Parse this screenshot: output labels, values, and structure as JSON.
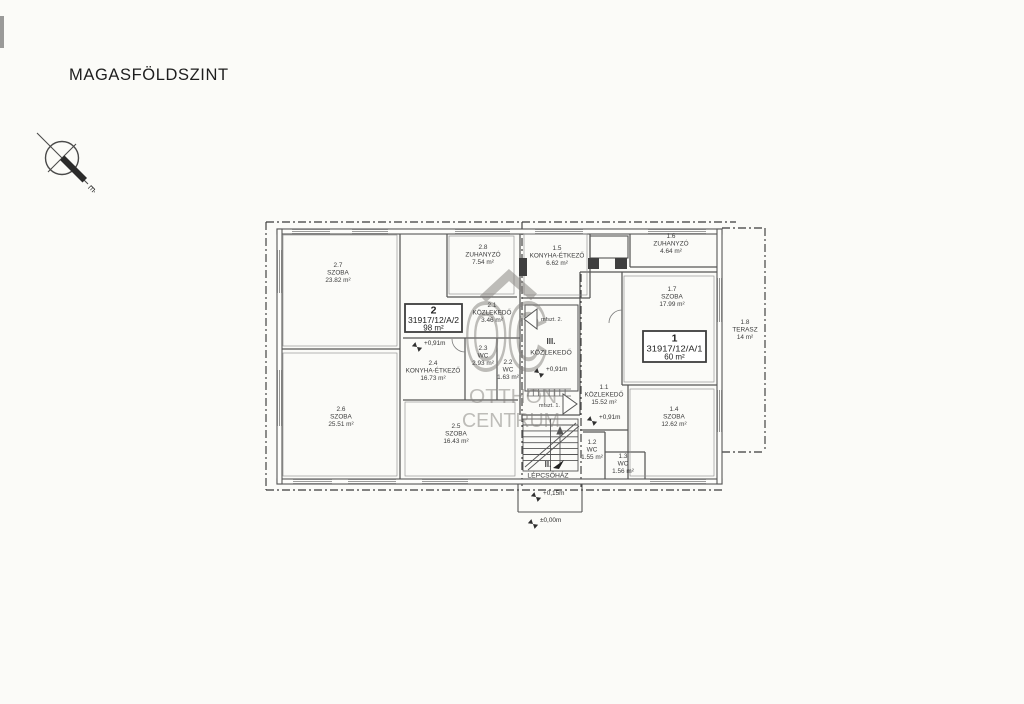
{
  "page": {
    "title": "MAGASFÖLDSZINT"
  },
  "compass": {
    "north_label": "É"
  },
  "watermark": {
    "logo": "OC",
    "line1": "OTTHON",
    "line2": "CENTRUM"
  },
  "units": [
    {
      "number": "2",
      "parcel": "31917/12/A/2",
      "area": "98 m²"
    },
    {
      "number": "1",
      "parcel": "31917/12/A/1",
      "area": "60 m²"
    }
  ],
  "rooms": [
    {
      "num": "2.7",
      "name": "SZOBA",
      "area": "23.82 m²",
      "x": 338,
      "y": 267
    },
    {
      "num": "2.6",
      "name": "SZOBA",
      "area": "25.51 m²",
      "x": 341,
      "y": 411
    },
    {
      "num": "2.8",
      "name": "ZUHANYZÓ",
      "area": "7.54 m²",
      "x": 483,
      "y": 249
    },
    {
      "num": "2.1",
      "name": "KÖZLEKEDŐ",
      "area": "3.46 m²",
      "x": 492,
      "y": 307
    },
    {
      "num": "2.3",
      "name": "WC",
      "area": "2.93 m²",
      "x": 483,
      "y": 350
    },
    {
      "num": "2.2",
      "name": "WC",
      "area": "1.63 m²",
      "x": 508,
      "y": 364
    },
    {
      "num": "2.4",
      "name": "KONYHA-ÉTKEZŐ",
      "area": "16.73 m²",
      "x": 433,
      "y": 365
    },
    {
      "num": "2.5",
      "name": "SZOBA",
      "area": "16.43 m²",
      "x": 456,
      "y": 428
    },
    {
      "num": "1.5",
      "name": "KONYHA-ÉTKEZŐ",
      "area": "6.62 m²",
      "x": 557,
      "y": 250
    },
    {
      "num": "1.6",
      "name": "ZUHANYZÓ",
      "area": "4.64 m²",
      "x": 671,
      "y": 238
    },
    {
      "num": "1.7",
      "name": "SZOBA",
      "area": "17.99 m²",
      "x": 672,
      "y": 291
    },
    {
      "num": "1.1",
      "name": "KÖZLEKEDŐ",
      "area": "15.52 m²",
      "x": 604,
      "y": 389
    },
    {
      "num": "1.2",
      "name": "WC",
      "area": "1.55 m²",
      "x": 592,
      "y": 444
    },
    {
      "num": "1.3",
      "name": "WC",
      "area": "1.56 m²",
      "x": 623,
      "y": 458
    },
    {
      "num": "1.4",
      "name": "SZOBA",
      "area": "12.62 m²",
      "x": 674,
      "y": 411
    },
    {
      "num": "1.8",
      "name": "TERASZ",
      "area": "14 m²",
      "x": 745,
      "y": 324
    },
    {
      "num": "III.",
      "name": "KÖZLEKEDŐ",
      "area": "",
      "x": 551,
      "y": 344,
      "big": true
    },
    {
      "num": "II.",
      "name": "LÉPCSŐHÁZ",
      "area": "",
      "x": 548,
      "y": 467,
      "big": true
    }
  ],
  "levels": [
    {
      "text": "+0,91m",
      "x": 424,
      "y": 345
    },
    {
      "text": "+0,91m",
      "x": 546,
      "y": 371
    },
    {
      "text": "+0,91m",
      "x": 599,
      "y": 419
    },
    {
      "text": "+0,15m",
      "x": 543,
      "y": 495
    },
    {
      "text": "±0,00m",
      "x": 540,
      "y": 522
    }
  ],
  "doors": [
    {
      "label": "mfszt. 2."
    },
    {
      "label": "mfszt. 1."
    }
  ]
}
